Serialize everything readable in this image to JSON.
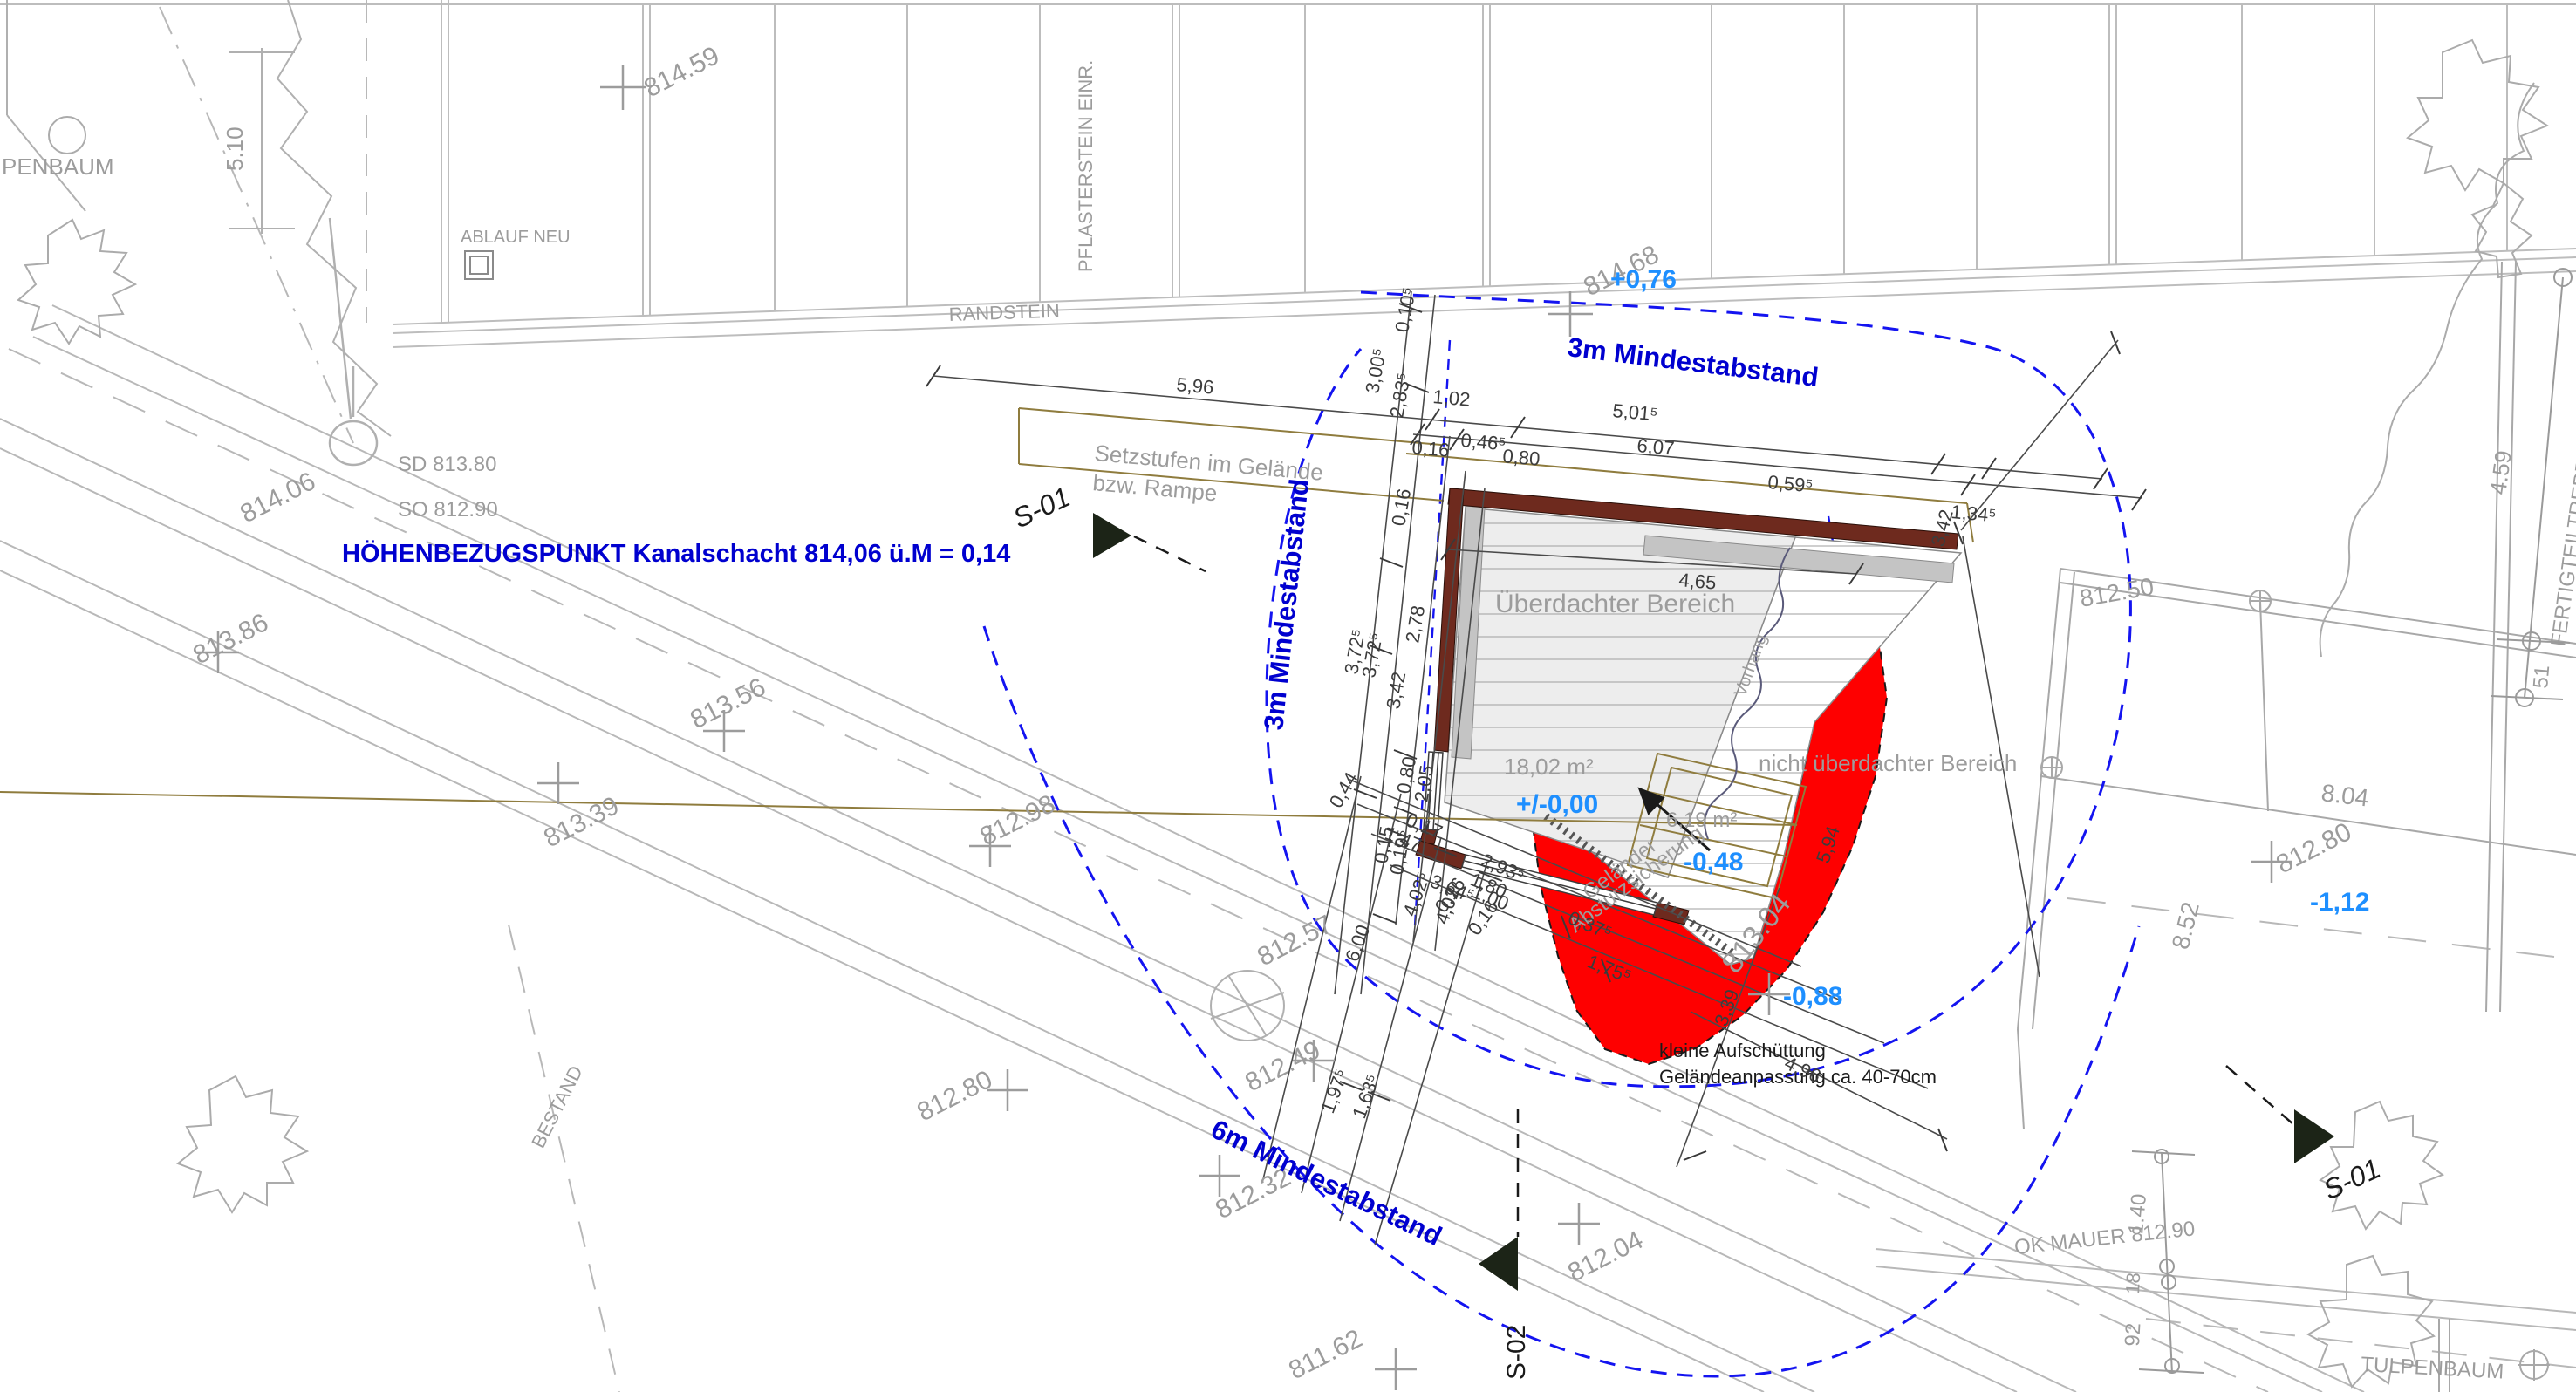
{
  "drawing_title": "Lageplan Bauvorhaben Terrasse",
  "colors": {
    "line_gray": "#b5b5b5",
    "text_gray": "#9c9c9c",
    "dim_black": "#3c3c3c",
    "setback_blue": "#0000cf",
    "level_blue": "#1e8fff",
    "fill_red": "#fe0000",
    "wall_brown": "#6e2a1e",
    "ramp_tan": "#8f7c3e",
    "deck_gray": "#ededed"
  },
  "reference": {
    "hoehenbezug": "HÖHENBEZUGSPUNKT  Kanalschacht 814,06 ü.M = 0,14",
    "sd": "SD 813.80",
    "so": "SO 812.90"
  },
  "setbacks": {
    "m3_top": "3m Mindestabstand",
    "m3_side": "3m Mindestabstand",
    "m6": "6m Mindestabstand"
  },
  "levels": {
    "p076": "+0,76",
    "p000": "+/-0,00",
    "m048": "-0,48",
    "m088": "-0,88",
    "m112": "-1,12"
  },
  "elevations": {
    "e81459": "814.59",
    "e81468": "814.68",
    "e81406": "814.06",
    "e81386": "813.86",
    "e81356": "813.56",
    "e81339": "813.39",
    "e81298": "812.98",
    "e81280l": "812.80",
    "e81257": "812.57",
    "e81249": "812.49",
    "e81232": "812.32",
    "e81204": "812.04",
    "e81162": "811.62",
    "e81250": "812.50",
    "e81280r": "812.80",
    "e81304": "813.04"
  },
  "site_labels": {
    "penbaum": "PENBAUM",
    "tulpenbaum": "TULPENBAUM",
    "ablauf": "ABLAUF NEU",
    "randstein": "RANDSTEIN",
    "pflaster": "PFLASTERSTEIN EINR.",
    "fertigteil": "FERTIGTEILTREPPE",
    "bestand": "BESTAND",
    "okmauer": "OK MAUER 812.90"
  },
  "areas": {
    "covered_label": "Überdachter Bereich",
    "covered_area": "18,02 m²",
    "uncovered_label": "nicht überdachter Bereich",
    "uncovered_area": "6,19 m²",
    "railing1": "Geländer",
    "railing2": "Absturzsicherung",
    "vorhang": "Vorhang",
    "steps1": "Setzstufen im Gelände",
    "steps2": "bzw. Rampe",
    "fill1": "kleine Aufschüttung",
    "fill2": "Geländeanpassung ca. 40-70cm"
  },
  "sections": {
    "s01l": "S-01",
    "s01r": "S-01",
    "s02": "S-02"
  },
  "dims": {
    "d596": "5,96",
    "d102": "1,02",
    "d5015": "5,01⁵",
    "d0595": "0,59⁵",
    "d1345": "1,34⁵",
    "d342v": "3,42",
    "d0465": "0,46⁵",
    "d607": "6,07",
    "d016a": "0,16",
    "d080a": "0,80",
    "d465": "4,65",
    "d0105": "0,10⁵",
    "d3005": "3,00⁵",
    "d2835": "2,83⁵",
    "d016b": "0,16",
    "d278": "2,78",
    "d342": "3,42",
    "d3725a": "3,72⁵",
    "d3725b": "3,72⁵",
    "d080b": "0,80",
    "d205": "2,05",
    "d015": "0,15",
    "d0195": "0,19⁵",
    "d044": "0,44",
    "d016c": "0,16",
    "d016d": "0,16",
    "d017": "0,17",
    "d147": "1,47",
    "d2935": "2,93⁵",
    "d180": "1,80",
    "d100": "1,00",
    "d3645": "3,64⁵",
    "d4025": "4,02⁵",
    "d402": "4,02",
    "d600": "6,00",
    "d0375": "0,37⁵",
    "d1755": "1,75⁵",
    "d1975": "1,97⁵",
    "d1635": "1,63⁵",
    "d339": "3,39",
    "d496": "4,96",
    "d594": "5,94",
    "d510": "5.10",
    "d459": "4.59",
    "d51": "51",
    "d140": "1.40",
    "d18": "18",
    "d92": "92",
    "d804": "8.04",
    "d852": "8.52"
  }
}
